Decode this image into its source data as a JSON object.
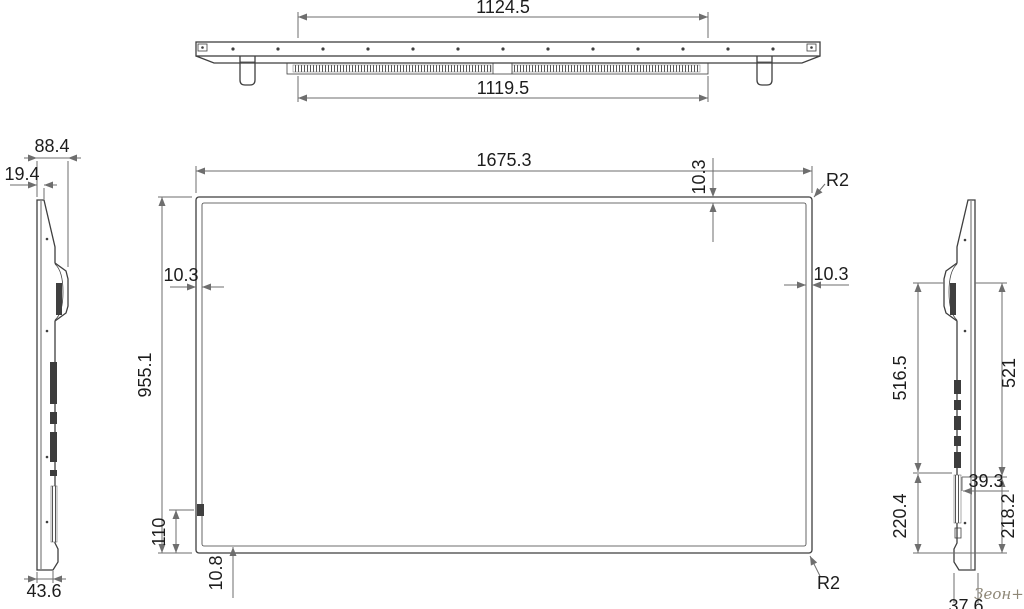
{
  "colors": {
    "background": "#ffffff",
    "line": "#3f3f3f",
    "dim": "#6e6e6e",
    "text": "#1d1d1d",
    "watermark": "#8e8777"
  },
  "top_view": {
    "dim_outer_width": "1124.5",
    "dim_inner_width": "1119.5"
  },
  "front_view": {
    "dim_width": "1675.3",
    "dim_height": "955.1",
    "dim_bezel_top": "10.3",
    "dim_bezel_left": "10.3",
    "dim_bezel_right": "10.3",
    "dim_corner_radius_top": "R2",
    "dim_corner_radius_bottom": "R2",
    "dim_bottom_offset": "110",
    "dim_bezel_bottom": "10.8"
  },
  "left_view": {
    "dim_depth_overall": "88.4",
    "dim_depth_top": "19.4",
    "dim_depth_bottom": "43.6"
  },
  "right_view": {
    "dim_upper_left": "516.5",
    "dim_upper_right": "521",
    "dim_port_inset": "39.3",
    "dim_lower_left": "220.4",
    "dim_lower_right": "218.2",
    "dim_bottom_depth": "37.6"
  },
  "watermark": {
    "text": "Зеон+"
  }
}
